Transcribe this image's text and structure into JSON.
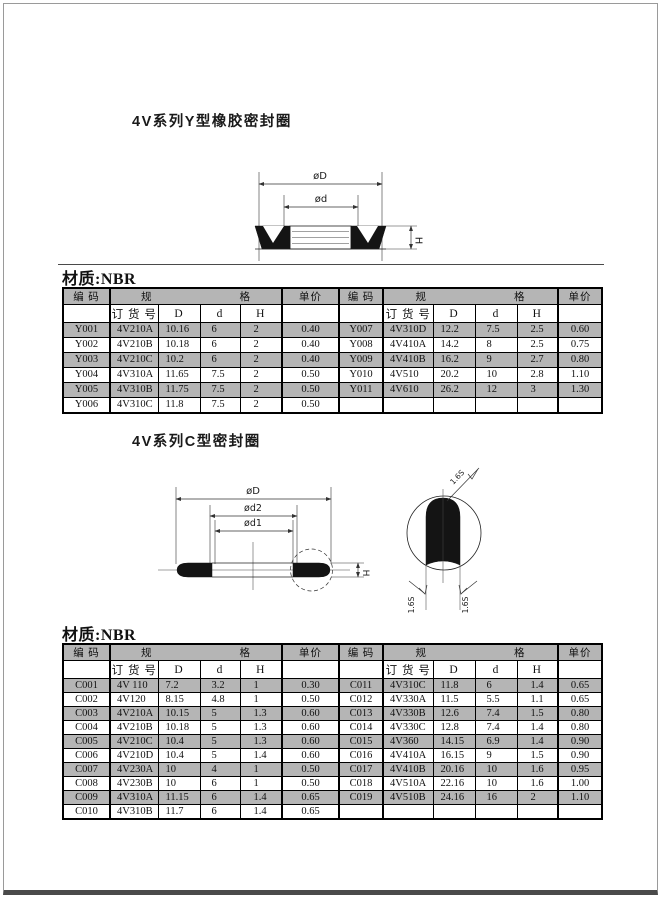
{
  "page": {
    "frame_color": "#9a9a9a",
    "footer_bar_color": "#4a4a4a",
    "row_shade_color": "#b5b5b5"
  },
  "sections": {
    "y": {
      "title": "4V系列Y型橡胶密封圈",
      "material": "材质:NBR"
    },
    "c": {
      "title": "4V系列C型密封圈",
      "material": "材质:NBR"
    }
  },
  "diagram_y": {
    "outer_dia": "øD",
    "inner_dia": "ød",
    "height_label": "H"
  },
  "diagram_c": {
    "outer_dia": "øD",
    "d2": "ød2",
    "d1": "ød1",
    "height_label": "H",
    "finish_top": "1.6S",
    "finish_left": "1.6S",
    "finish_right": "1.6S"
  },
  "table_headers": {
    "code": "编 码",
    "spec": "规                        格",
    "price": "单价",
    "order_no": "订 货 号",
    "D": "D",
    "d": "d",
    "H": "H"
  },
  "table_y": {
    "left": [
      [
        "Y001",
        "4V210A",
        "10.16",
        "6",
        "2",
        "0.40"
      ],
      [
        "Y002",
        "4V210B",
        "10.18",
        "6",
        "2",
        "0.40"
      ],
      [
        "Y003",
        "4V210C",
        "10.2",
        "6",
        "2",
        "0.40"
      ],
      [
        "Y004",
        "4V310A",
        "11.65",
        "7.5",
        "2",
        "0.50"
      ],
      [
        "Y005",
        "4V310B",
        "11.75",
        "7.5",
        "2",
        "0.50"
      ],
      [
        "Y006",
        "4V310C",
        "11.8",
        "7.5",
        "2",
        "0.50"
      ]
    ],
    "right": [
      [
        "Y007",
        "4V310D",
        "12.2",
        "7.5",
        "2.5",
        "0.60"
      ],
      [
        "Y008",
        "4V410A",
        "14.2",
        "8",
        "2.5",
        "0.75"
      ],
      [
        "Y009",
        "4V410B",
        "16.2",
        "9",
        "2.7",
        "0.80"
      ],
      [
        "Y010",
        "4V510",
        "20.2",
        "10",
        "2.8",
        "1.10"
      ],
      [
        "Y011",
        "4V610",
        "26.2",
        "12",
        "3",
        "1.30"
      ],
      [
        "",
        "",
        "",
        "",
        "",
        ""
      ]
    ]
  },
  "table_c": {
    "left": [
      [
        "C001",
        "4V 110",
        "7.2",
        "3.2",
        "1",
        "0.30"
      ],
      [
        "C002",
        "4V120",
        "8.15",
        "4.8",
        "1",
        "0.50"
      ],
      [
        "C003",
        "4V210A",
        "10.15",
        "5",
        "1.3",
        "0.60"
      ],
      [
        "C004",
        "4V210B",
        "10.18",
        "5",
        "1.3",
        "0.60"
      ],
      [
        "C005",
        "4V210C",
        "10.4",
        "5",
        "1.3",
        "0.60"
      ],
      [
        "C006",
        "4V210D",
        "10.4",
        "5",
        "1.4",
        "0.60"
      ],
      [
        "C007",
        "4V230A",
        "10",
        "4",
        "1",
        "0.50"
      ],
      [
        "C008",
        "4V230B",
        "10",
        "6",
        "1",
        "0.50"
      ],
      [
        "C009",
        "4V310A",
        "11.15",
        "6",
        "1.4",
        "0.65"
      ],
      [
        "C010",
        "4V310B",
        "11.7",
        "6",
        "1.4",
        "0.65"
      ]
    ],
    "right": [
      [
        "C011",
        "4V310C",
        "11.8",
        "6",
        "1.4",
        "0.65"
      ],
      [
        "C012",
        "4V330A",
        "11.5",
        "5.5",
        "1.1",
        "0.65"
      ],
      [
        "C013",
        "4V330B",
        "12.6",
        "7.4",
        "1.5",
        "0.80"
      ],
      [
        "C014",
        "4V330C",
        "12.8",
        "7.4",
        "1.4",
        "0.80"
      ],
      [
        "C015",
        "4V360",
        "14.15",
        "6.9",
        "1.4",
        "0.90"
      ],
      [
        "C016",
        "4V410A",
        "16.15",
        "9",
        "1.5",
        "0.90"
      ],
      [
        "C017",
        "4V410B",
        "20.16",
        "10",
        "1.6",
        "0.95"
      ],
      [
        "C018",
        "4V510A",
        "22.16",
        "10",
        "1.6",
        "1.00"
      ],
      [
        "C019",
        "4V510B",
        "24.16",
        "16",
        "2",
        "1.10"
      ],
      [
        "",
        "",
        "",
        "",
        "",
        ""
      ]
    ]
  }
}
